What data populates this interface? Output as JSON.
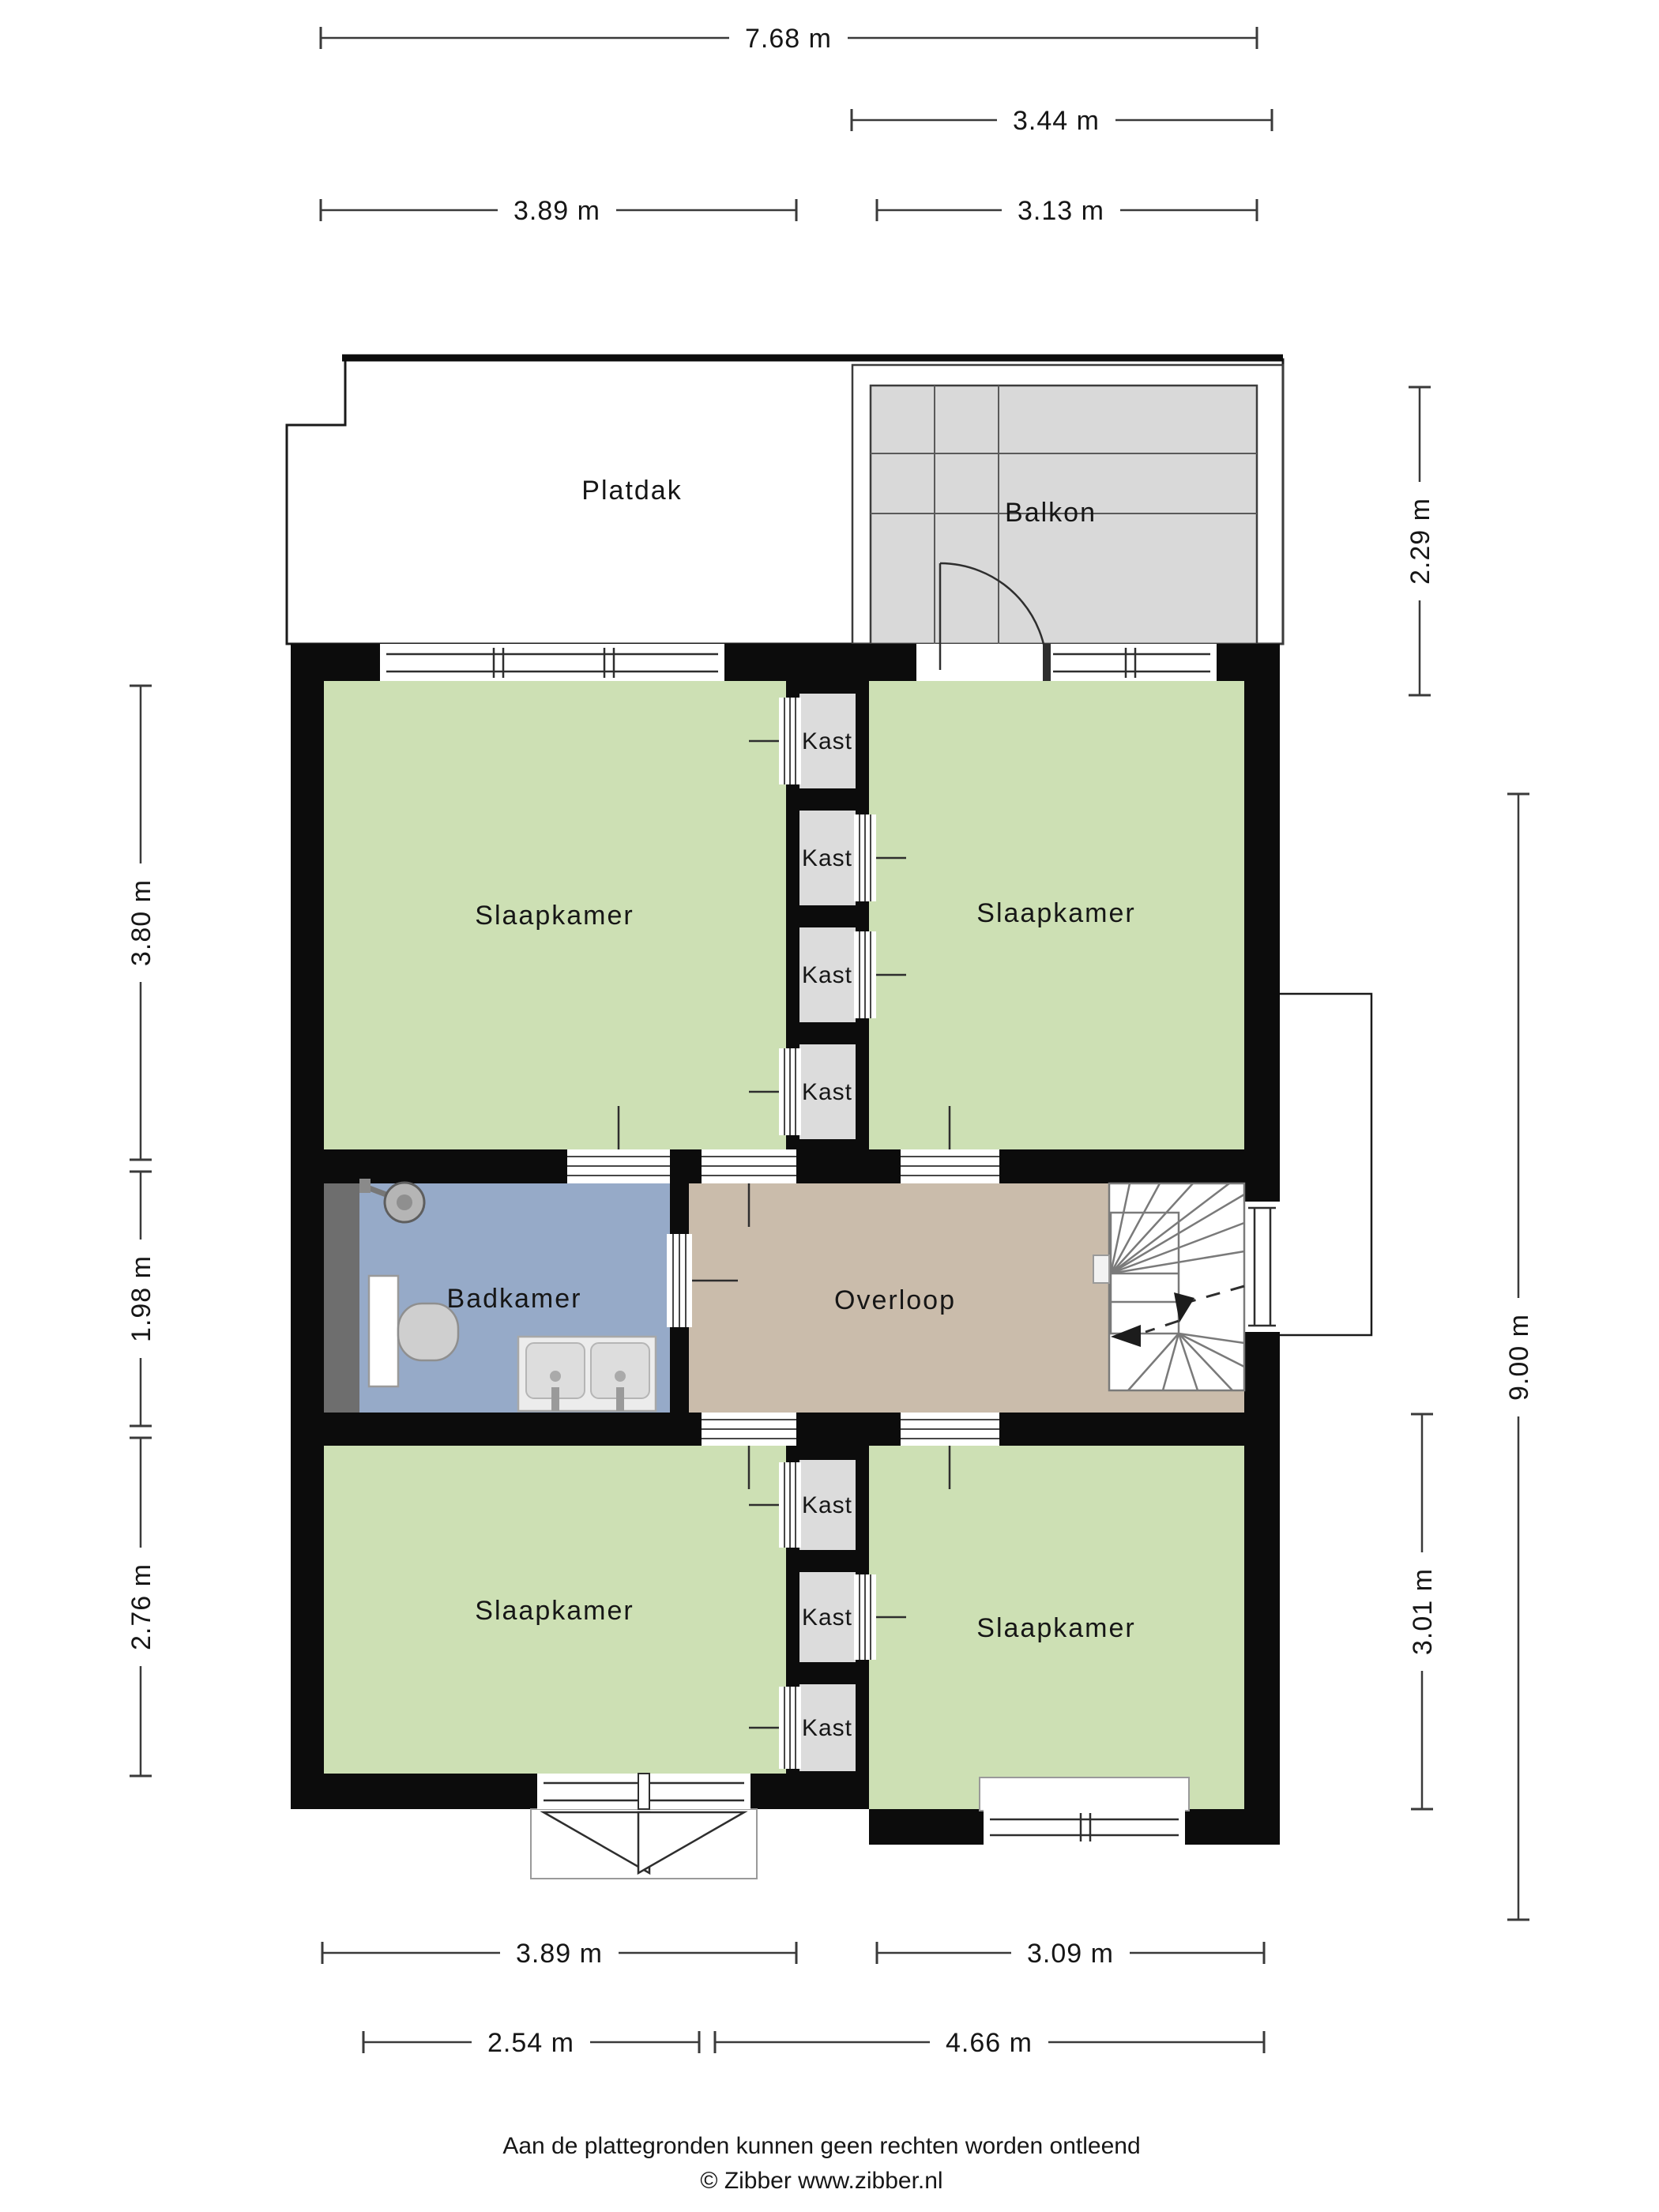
{
  "labels": {
    "slaapkamer": "Slaapkamer",
    "badkamer": "Badkamer",
    "overloop": "Overloop",
    "kast": "Kast",
    "platdak": "Platdak",
    "balkon": "Balkon"
  },
  "dimensions": {
    "top_total": "7.68 m",
    "top_balcony": "3.44 m",
    "top_left": "3.89 m",
    "top_right": "3.13 m",
    "left_top": "3.80 m",
    "left_middle": "1.98 m",
    "left_bottom": "2.76 m",
    "right_balcony": "2.29 m",
    "right_total": "9.00 m",
    "right_bottom": "3.01 m",
    "bottom_left": "3.89 m",
    "bottom_right": "3.09 m",
    "bottom2_left": "2.54 m",
    "bottom2_right": "4.66 m"
  },
  "footer": {
    "disclaimer": "Aan de plattegronden kunnen geen rechten worden ontleend",
    "credit": "© Zibber www.zibber.nl"
  },
  "colors": {
    "room_green": "#cde0b4",
    "bathroom_blue": "#96aac8",
    "landing_tan": "#cabcab",
    "closet_gray": "#dcdcdc",
    "balcony_gray": "#d9d9d9",
    "shaft_gray": "#6e6e6e",
    "wall_black": "#0c0c0c"
  }
}
